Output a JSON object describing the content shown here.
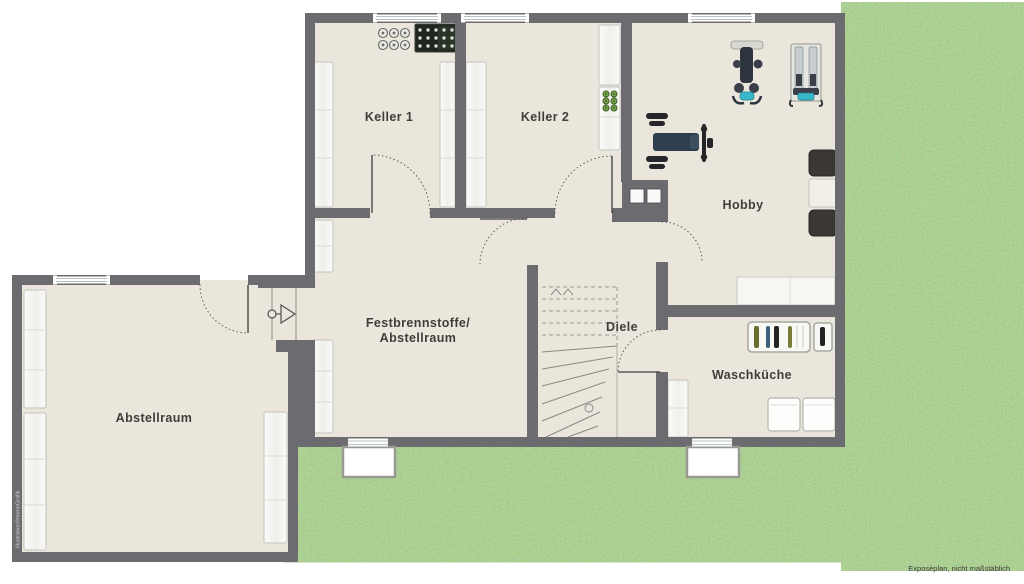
{
  "plan_title": "Kellergeschoss-Grundriss",
  "rooms": {
    "keller1": {
      "label": "Keller 1"
    },
    "keller2": {
      "label": "Keller 2"
    },
    "hobby": {
      "label": "Hobby"
    },
    "festbrennstoffe": {
      "label_line1": "Festbrennstoffe/",
      "label_line2": "Abstellraum"
    },
    "diele": {
      "label": "Diele"
    },
    "waschkueche": {
      "label": "Waschküche"
    },
    "abstellraum": {
      "label": "Abstellraum"
    }
  },
  "annotations": {
    "watermark": "Illustration©ImmoGrafik",
    "disclaimer": "Exposéplan, nicht maßstäblich"
  },
  "icons": [
    "shelf",
    "window",
    "light-well",
    "door-arc",
    "door-symbol",
    "stairs-icon",
    "preserving-jars-icon",
    "bottle-crate-icon",
    "exercise-machine-icon",
    "strength-machine-icon",
    "weight-bench-icon",
    "chair-icon",
    "table-icon",
    "sideboard-icon",
    "drying-rack-icon",
    "washing-machine-icon",
    "chimney"
  ],
  "colors": {
    "wall": "#6c6b70",
    "floor": "#eae6db",
    "grass": "#68a14a",
    "equipment_accent": "#39b8c9",
    "label_text": "#3e3e3b"
  }
}
